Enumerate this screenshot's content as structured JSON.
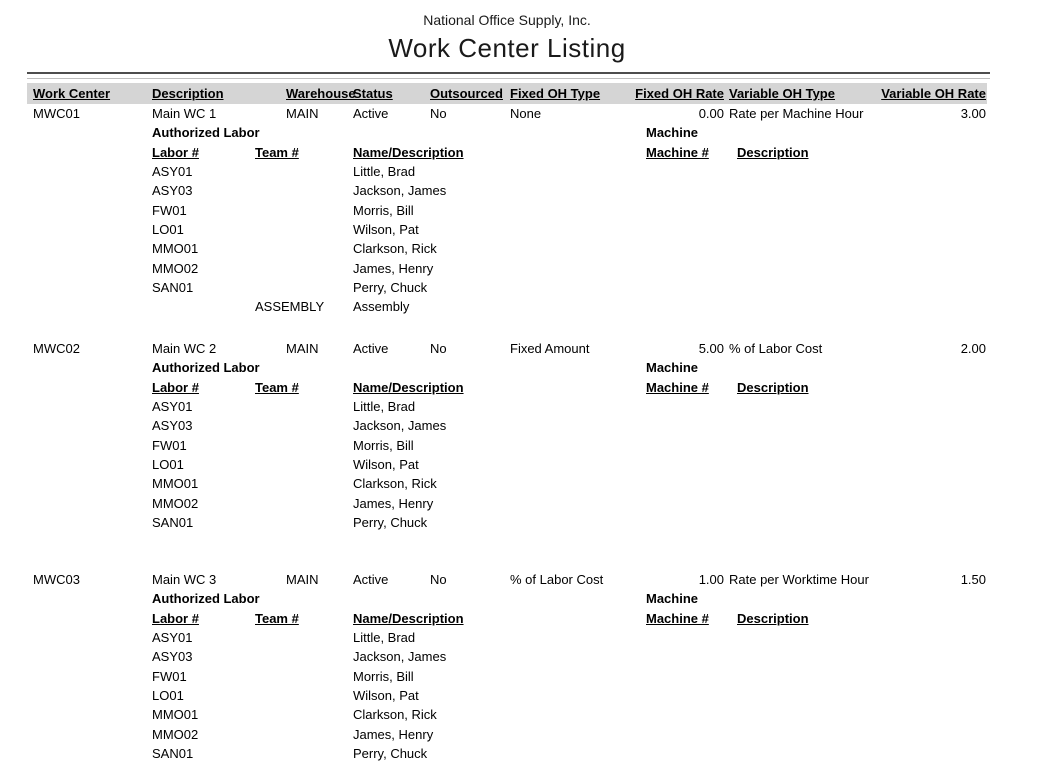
{
  "report": {
    "company": "National Office Supply, Inc.",
    "title": "Work Center Listing"
  },
  "columns": {
    "work_center": "Work Center",
    "description": "Description",
    "warehouse": "Warehouse",
    "status": "Status",
    "outsourced": "Outsourced",
    "fixed_oh_type": "Fixed OH Type",
    "fixed_oh_rate": "Fixed OH Rate",
    "variable_oh_type": "Variable OH Type",
    "variable_oh_rate": "Variable OH Rate"
  },
  "labels": {
    "authorized_labor": "Authorized Labor",
    "machine": "Machine",
    "labor_no": "Labor #",
    "team_no": "Team #",
    "name_description": "Name/Description",
    "machine_no": "Machine #",
    "machine_description": "Description"
  },
  "colors": {
    "header_band": "#d5d5d5",
    "rule_dark": "#4d4d4d",
    "rule_light": "#bdbdbd",
    "text": "#000000"
  },
  "work_centers": [
    {
      "work_center": "MWC01",
      "description": "Main WC 1",
      "warehouse": "MAIN",
      "status": "Active",
      "outsourced": "No",
      "fixed_oh_type": "None",
      "fixed_oh_rate": "0.00",
      "variable_oh_type": "Rate per Machine Hour",
      "variable_oh_rate": "3.00",
      "labor": [
        {
          "labor_no": "ASY01",
          "team_no": "",
          "name": "Little, Brad"
        },
        {
          "labor_no": "ASY03",
          "team_no": "",
          "name": "Jackson, James"
        },
        {
          "labor_no": "FW01",
          "team_no": "",
          "name": "Morris, Bill"
        },
        {
          "labor_no": "LO01",
          "team_no": "",
          "name": "Wilson, Pat"
        },
        {
          "labor_no": "MMO01",
          "team_no": "",
          "name": "Clarkson, Rick"
        },
        {
          "labor_no": "MMO02",
          "team_no": "",
          "name": "James, Henry"
        },
        {
          "labor_no": "SAN01",
          "team_no": "",
          "name": "Perry, Chuck"
        },
        {
          "labor_no": "",
          "team_no": "ASSEMBLY",
          "name": "Assembly"
        }
      ],
      "machines": []
    },
    {
      "work_center": "MWC02",
      "description": "Main WC 2",
      "warehouse": "MAIN",
      "status": "Active",
      "outsourced": "No",
      "fixed_oh_type": "Fixed Amount",
      "fixed_oh_rate": "5.00",
      "variable_oh_type": "% of Labor Cost",
      "variable_oh_rate": "2.00",
      "labor": [
        {
          "labor_no": "ASY01",
          "team_no": "",
          "name": "Little, Brad"
        },
        {
          "labor_no": "ASY03",
          "team_no": "",
          "name": "Jackson, James"
        },
        {
          "labor_no": "FW01",
          "team_no": "",
          "name": "Morris, Bill"
        },
        {
          "labor_no": "LO01",
          "team_no": "",
          "name": "Wilson, Pat"
        },
        {
          "labor_no": "MMO01",
          "team_no": "",
          "name": "Clarkson, Rick"
        },
        {
          "labor_no": "MMO02",
          "team_no": "",
          "name": "James, Henry"
        },
        {
          "labor_no": "SAN01",
          "team_no": "",
          "name": "Perry, Chuck"
        }
      ],
      "machines": []
    },
    {
      "work_center": "MWC03",
      "description": "Main WC 3",
      "warehouse": "MAIN",
      "status": "Active",
      "outsourced": "No",
      "fixed_oh_type": "% of Labor Cost",
      "fixed_oh_rate": "1.00",
      "variable_oh_type": "Rate per Worktime Hour",
      "variable_oh_rate": "1.50",
      "labor": [
        {
          "labor_no": "ASY01",
          "team_no": "",
          "name": "Little, Brad"
        },
        {
          "labor_no": "ASY03",
          "team_no": "",
          "name": "Jackson, James"
        },
        {
          "labor_no": "FW01",
          "team_no": "",
          "name": "Morris, Bill"
        },
        {
          "labor_no": "LO01",
          "team_no": "",
          "name": "Wilson, Pat"
        },
        {
          "labor_no": "MMO01",
          "team_no": "",
          "name": "Clarkson, Rick"
        },
        {
          "labor_no": "MMO02",
          "team_no": "",
          "name": "James, Henry"
        },
        {
          "labor_no": "SAN01",
          "team_no": "",
          "name": "Perry, Chuck"
        }
      ],
      "machines": []
    }
  ]
}
